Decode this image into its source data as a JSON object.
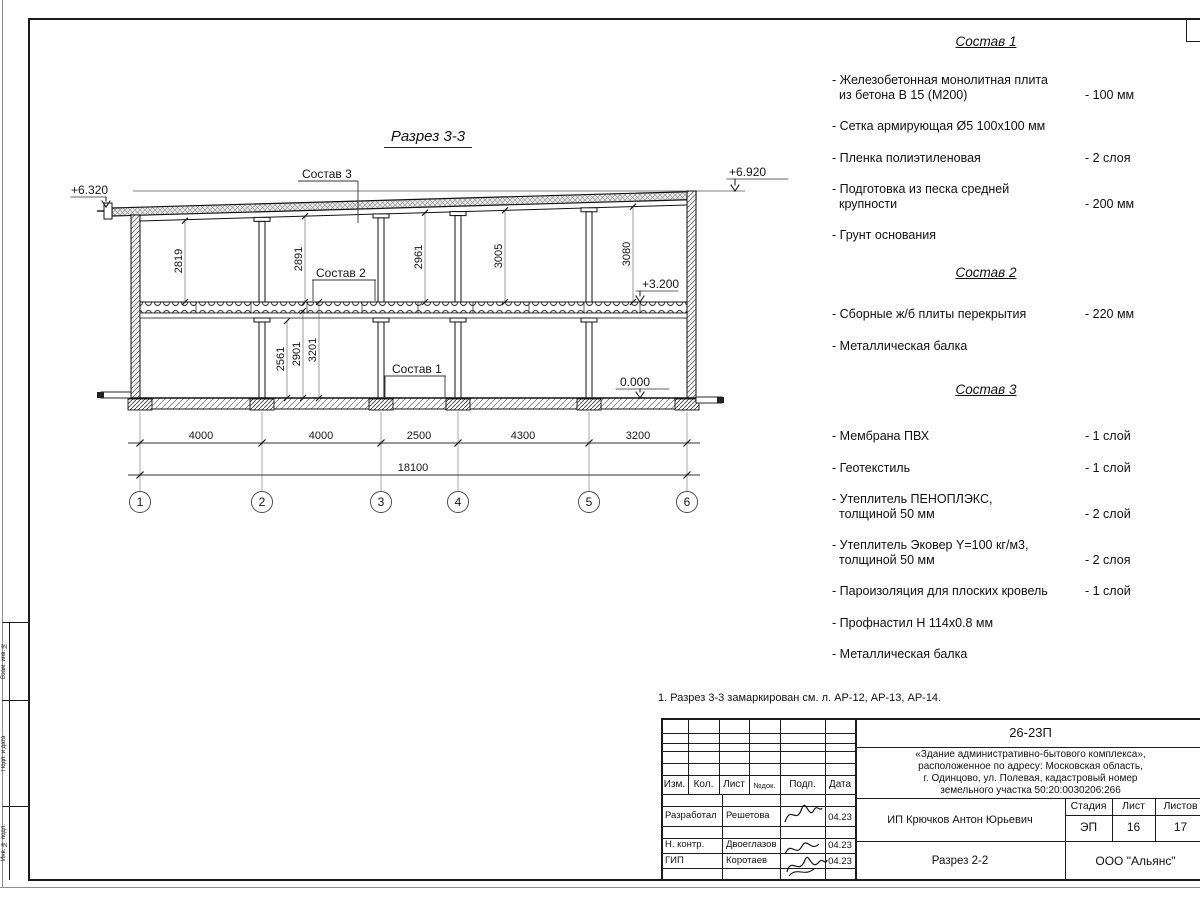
{
  "drawing": {
    "title": "Разрез 3-3",
    "labels": {
      "sostav1": "Состав 1",
      "sostav2": "Состав 2",
      "sostav3": "Состав 3"
    },
    "elevations": {
      "roof_left": "+6.320",
      "roof_right": "+6.920",
      "floor2": "+3.200",
      "ground": "0.000"
    },
    "dims_storey2": [
      "2819",
      "2891",
      "2961",
      "3005",
      "3080"
    ],
    "dims_storey1": [
      "2561",
      "2901",
      "3201"
    ],
    "dims_spans": [
      "4000",
      "4000",
      "2500",
      "4300",
      "3200"
    ],
    "dim_total": "18100",
    "grid_axes": [
      "1",
      "2",
      "3",
      "4",
      "5",
      "6"
    ]
  },
  "compositions": [
    {
      "title": "Состав 1",
      "items": [
        {
          "line1": "- Железобетонная  монолитная плита",
          "line2": "из бетона В 15 (М200)",
          "value": "- 100 мм"
        },
        {
          "line1": "- Сетка армирующая Ø5 100х100 мм",
          "line2": "",
          "value": ""
        },
        {
          "line1": "- Пленка полиэтиленовая",
          "line2": "",
          "value": "-  2 слоя"
        },
        {
          "line1": "- Подготовка из песка средней",
          "line2": "крупности",
          "value": "- 200 мм"
        },
        {
          "line1": "- Грунт основания",
          "line2": "",
          "value": ""
        }
      ]
    },
    {
      "title": "Состав 2",
      "items": [
        {
          "line1": "- Сборные ж/б плиты перекрытия",
          "line2": "",
          "value": "- 220 мм"
        },
        {
          "line1": "- Металлическая балка",
          "line2": "",
          "value": ""
        }
      ]
    },
    {
      "title": "Состав 3",
      "items": [
        {
          "line1": "- Мембрана ПВХ",
          "line2": "",
          "value": "- 1 слой"
        },
        {
          "line1": "- Геотекстиль",
          "line2": "",
          "value": "- 1 слой"
        },
        {
          "line1": "- Утеплитель ПЕНОПЛЭКС,",
          "line2": "толщиной 50 мм",
          "value": "- 2 слой"
        },
        {
          "line1": "- Утеплитель Эковер Y=100 кг/м3,",
          "line2": "толщиной 50 мм",
          "value": "- 2 слоя"
        },
        {
          "line1": "- Пароизоляция для плоских кровель",
          "line2": "",
          "value": "- 1 слой"
        },
        {
          "line1": "- Профнастил Н 114х0.8 мм",
          "line2": "",
          "value": ""
        },
        {
          "line1": "- Металлическая балка",
          "line2": "",
          "value": ""
        }
      ]
    }
  ],
  "note": "1. Разрез 3-3 замаркирован см. л. АР-12, АР-13, АР-14.",
  "title_block": {
    "doc_number": "26-23П",
    "object_lines": [
      "«Здание административно-бытового комплекса»,",
      "расположенное по адресу: Московская область,",
      "г. Одинцово, ул. Полевая, кадастровый номер",
      "земельного участка 50:20:0030206:266"
    ],
    "cols": {
      "izm": "Изм.",
      "kol": "Кол.",
      "list": "Лист",
      "ndok": "№док.",
      "podp": "Подп.",
      "data": "Дата"
    },
    "rows": [
      {
        "role": "Разработал",
        "name": "Решетова",
        "date": "04.23"
      },
      {
        "role": "Н. контр.",
        "name": "Двоеглазов",
        "date": "04.23"
      },
      {
        "role": "ГИП",
        "name": "Коротаев",
        "date": "04.23"
      }
    ],
    "customer": "ИП Крючков Антон Юрьевич",
    "sheet_title": "Разрез 2-2",
    "company": "ООО \"Альянс\"",
    "stage_label": "Стадия",
    "sheet_label": "Лист",
    "sheets_label": "Листов",
    "stage": "ЭП",
    "sheet": "16",
    "sheets": "17"
  },
  "side_column": [
    "Взам. инв. №",
    "Подп. и дата",
    "Инв. № подл."
  ]
}
